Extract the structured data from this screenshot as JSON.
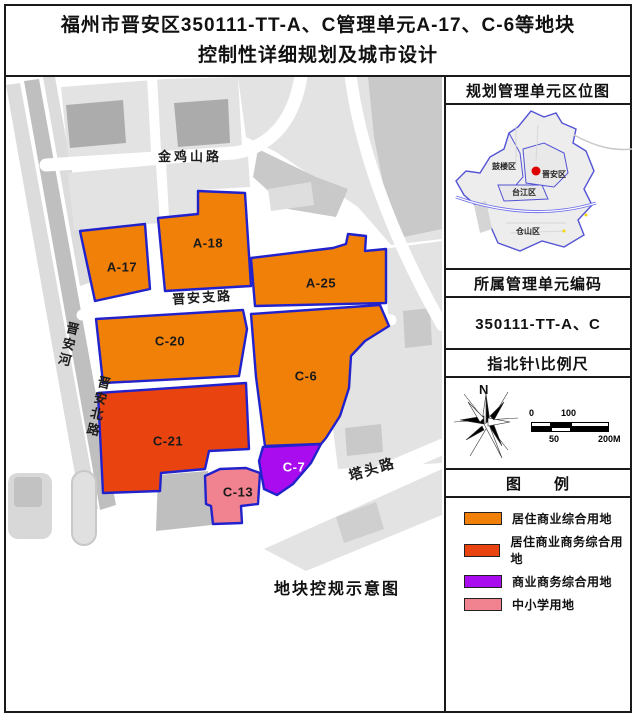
{
  "title": {
    "line1": "福州市晋安区350111-TT-A、C管理单元A-17、C-6等地块",
    "line2": "控制性详细规划及城市设计"
  },
  "map": {
    "caption": "地块控规示意图",
    "parcel_border_color": "#2222CC",
    "roads": {
      "jinjishan_road": "金鸡山路",
      "jinan_branch_road": "晋安支路",
      "jinan_river": "晋安河",
      "jinan_north_road": "晋安北路",
      "tatou_road": "塔头路"
    },
    "parcels": {
      "a17": {
        "label": "A-17",
        "color": "#F08008"
      },
      "a18": {
        "label": "A-18",
        "color": "#F08008"
      },
      "a25": {
        "label": "A-25",
        "color": "#F08008"
      },
      "c20": {
        "label": "C-20",
        "color": "#F08008"
      },
      "c6": {
        "label": "C-6",
        "color": "#F08008"
      },
      "c21": {
        "label": "C-21",
        "color": "#E9440F"
      },
      "c7": {
        "label": "C-7",
        "color": "#A80CEF"
      },
      "c13": {
        "label": "C-13",
        "color": "#F0838F"
      }
    }
  },
  "sidebar": {
    "location_map": {
      "title": "规划管理单元区位图",
      "districts": [
        "鼓楼区",
        "晋安区",
        "台江区",
        "仓山区"
      ],
      "marker_color": "#DD0000"
    },
    "unit_code": {
      "title": "所属管理单元编码",
      "value": "350111-TT-A、C"
    },
    "compass": {
      "title": "指北针\\比例尺",
      "north_label": "N",
      "scale_ticks": [
        "0",
        "50",
        "100",
        "200M"
      ]
    },
    "legend": {
      "title": "图　　例",
      "items": [
        {
          "label": "居住商业综合用地",
          "color": "#F08008"
        },
        {
          "label": "居住商业商务综合用地",
          "color": "#E9440F"
        },
        {
          "label": "商业商务综合用地",
          "color": "#A80CEF"
        },
        {
          "label": "中小学用地",
          "color": "#F0838F"
        }
      ]
    }
  }
}
